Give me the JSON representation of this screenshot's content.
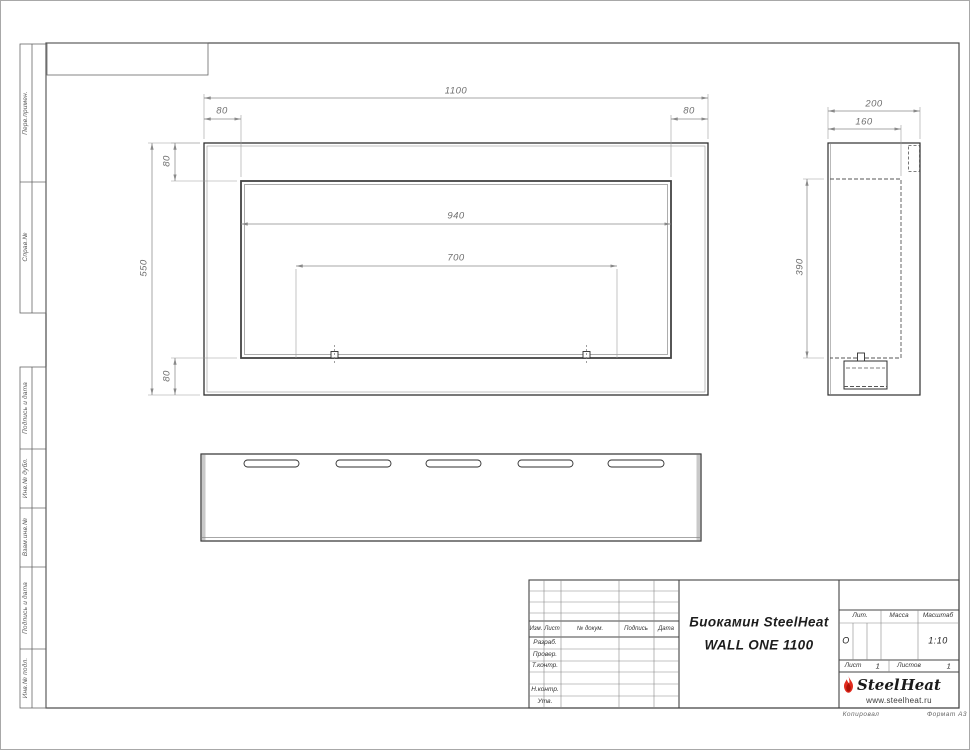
{
  "document": {
    "type_note": "Сборочный чертёж биокамина",
    "product_line1": "Биокамин SteelHeat",
    "product_line2": "WALL ONE 1100"
  },
  "left_margin": {
    "labels": [
      "Перв.примен.",
      "Справ.№",
      "Подпись и дата",
      "Инв.№ дубл.",
      "Взам.инв.№",
      "Подпись и дата",
      "Инв.№ подл."
    ]
  },
  "views": {
    "front": {
      "width": "1100",
      "margin_left": "80",
      "margin_right": "80",
      "margin_top": "80",
      "height": "550",
      "opening_width": "940",
      "burner_width": "700",
      "margin_bottom": "80"
    },
    "side": {
      "depth": "200",
      "inner_depth": "160",
      "inner_height": "390"
    }
  },
  "title_block": {
    "columns": [
      "Изм.",
      "Лист",
      "№ докум.",
      "Подпись",
      "Дата"
    ],
    "row_labels": [
      "Разраб.",
      "Провер.",
      "Т.контр.",
      "Н.контр.",
      "Утв."
    ],
    "litera_label": "Лит.",
    "mass_label": "Масса",
    "scale_label": "Масштаб",
    "litera_value": "О",
    "mass_value": "",
    "scale_value": "1:10",
    "sheet_label": "Лист",
    "sheet_number": "1",
    "sheets_label": "Листов",
    "sheets_total": "1"
  },
  "logo": {
    "steel": "Steel",
    "heat": "Heat",
    "url": "www.steelheat.ru",
    "flame_color": "#e12b1e"
  },
  "footer": {
    "copied": "Копировал",
    "format": "Формат А3"
  }
}
